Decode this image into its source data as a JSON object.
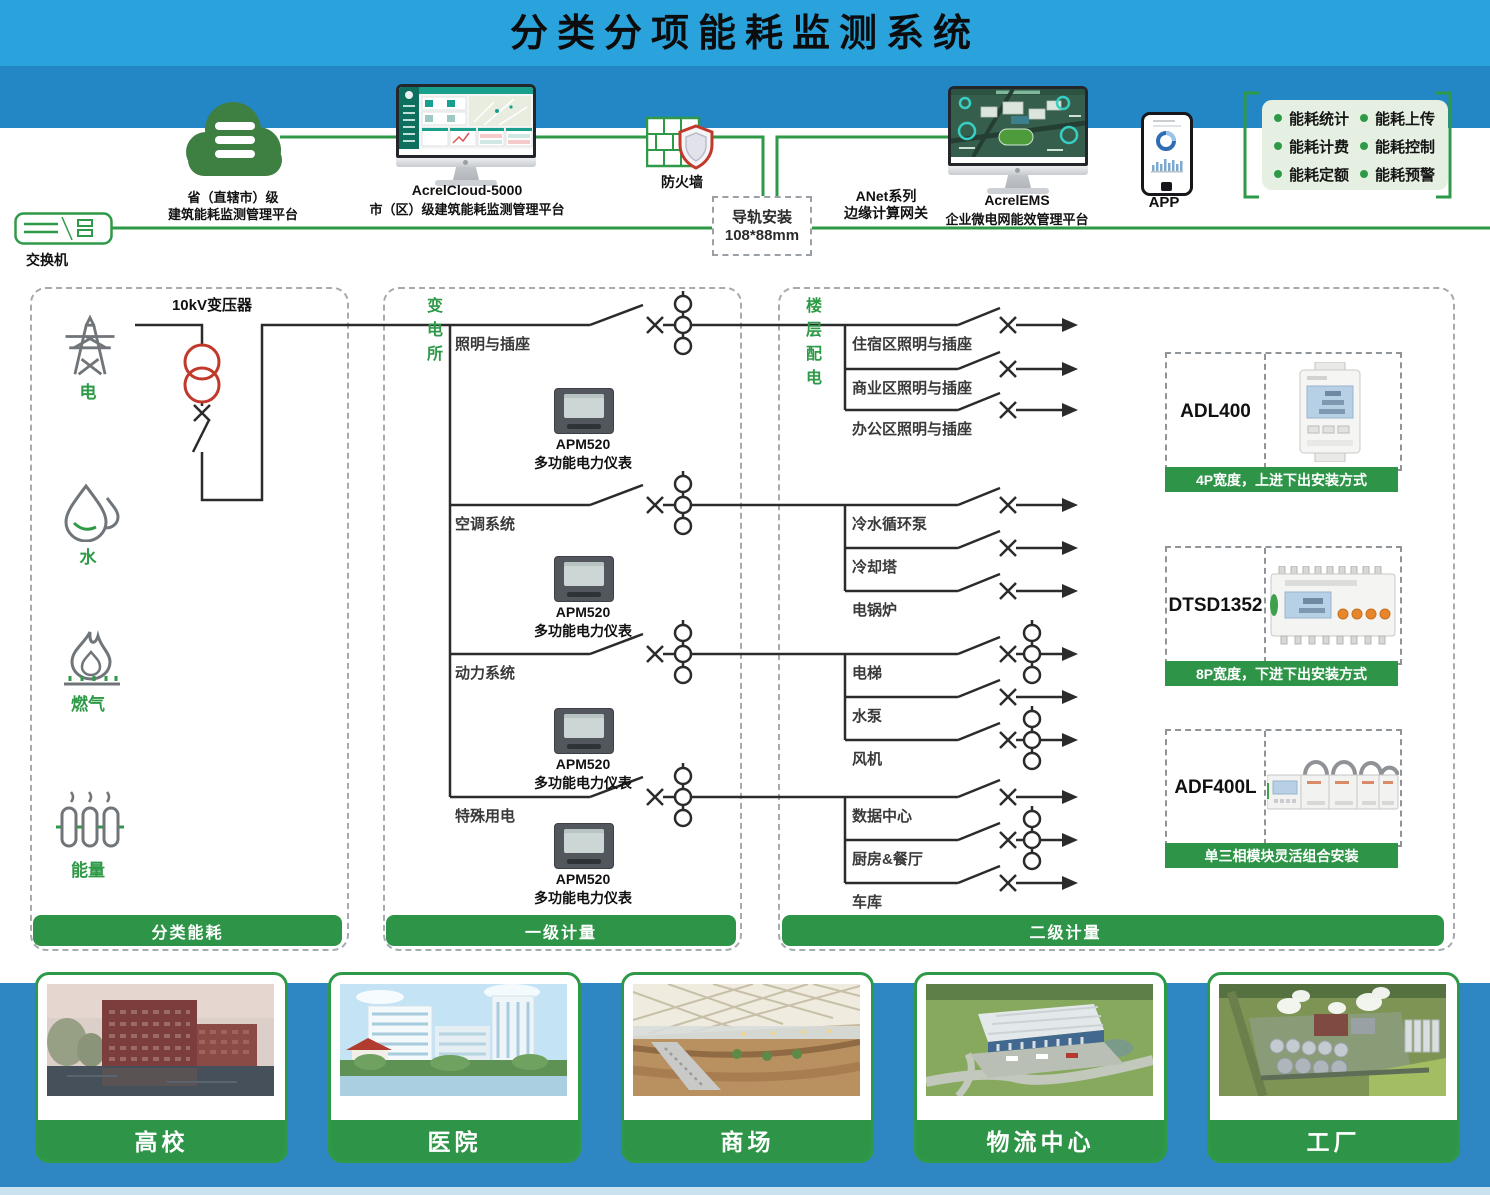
{
  "title": "分类分项能耗监测系统",
  "colors": {
    "accent_green": "#2E9A47",
    "header_blue": "#2AA3DC",
    "band_blue": "#2487C5",
    "footer_blue": "#2E86C2",
    "line_dark": "#2B2B2B",
    "transformer_red": "#C0392B",
    "feature_bg": "#E6F0E2"
  },
  "top": {
    "cloud_label": [
      "省（直辖市）级",
      "建筑能耗监测管理平台"
    ],
    "monitor1_title": "AcrelCloud-5000",
    "monitor1_subtitle": "市（区）级建筑能耗监测管理平台",
    "firewall_label": "防火墙",
    "switch_label": "交换机",
    "din_box": [
      "导轨安装",
      "108*88mm"
    ],
    "gateway_label": [
      "ANet系列",
      "边缘计算网关"
    ],
    "monitor2_title": "AcrelEMS",
    "monitor2_subtitle": "企业微电网能效管理平台",
    "app_label": "APP",
    "features": [
      "能耗统计",
      "能耗上传",
      "能耗计费",
      "能耗控制",
      "能耗定额",
      "能耗预警"
    ]
  },
  "classified": {
    "transformer_label": "10kV变压器",
    "energy_types": [
      "电",
      "水",
      "燃气",
      "能量"
    ],
    "footer": "分类能耗"
  },
  "substation": {
    "title": "变电所",
    "branches": [
      "照明与插座",
      "空调系统",
      "动力系统",
      "特殊用电"
    ],
    "meter_model": "APM520",
    "meter_desc": "多功能电力仪表",
    "footer": "一级计量"
  },
  "floor": {
    "title": "楼层配电",
    "circuits": [
      "住宿区照明与插座",
      "商业区照明与插座",
      "办公区照明与插座",
      "冷水循环泵",
      "冷却塔",
      "电锅炉",
      "电梯",
      "水泵",
      "风机",
      "数据中心",
      "厨房&餐厅",
      "车库"
    ],
    "footer": "二级计量"
  },
  "products": [
    {
      "model": "ADL400",
      "caption": "4P宽度，上进下出安装方式"
    },
    {
      "model": "DTSD1352",
      "caption": "8P宽度，下进下出安装方式"
    },
    {
      "model": "ADF400L",
      "caption": "单三相模块灵活组合安装"
    }
  ],
  "applications": [
    "高校",
    "医院",
    "商场",
    "物流中心",
    "工厂"
  ]
}
